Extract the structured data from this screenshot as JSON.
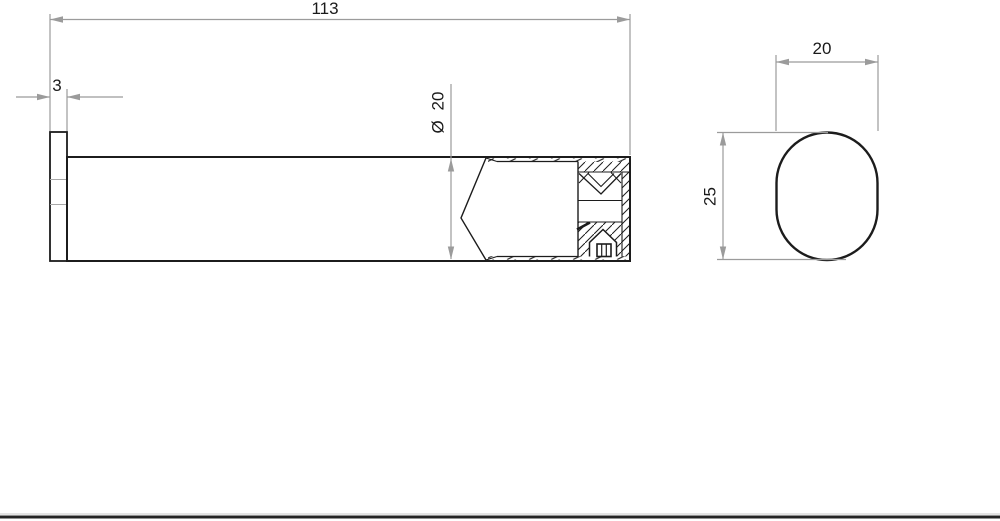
{
  "drawing": {
    "type": "technical-drawing",
    "views": {
      "front": {
        "dims": {
          "length": "113",
          "flange_thickness": "3",
          "diameter": "Ø 20"
        }
      },
      "side": {
        "dims": {
          "width": "20",
          "height": "25"
        }
      }
    },
    "colors": {
      "outline": "#1c1c1c",
      "dimension_line": "#9b9b9b",
      "text": "#1a1a1a",
      "background": "#ffffff",
      "bottom_rule": "#252525"
    }
  }
}
